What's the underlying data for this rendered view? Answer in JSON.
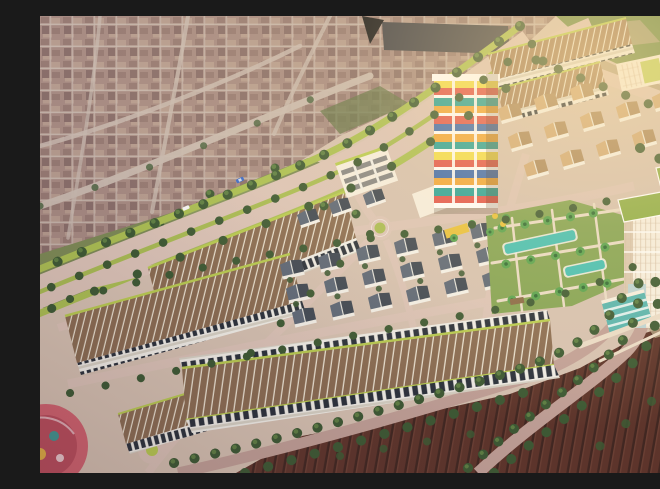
{
  "meta": {
    "title": "Aerial 3D architectural rendering of a residential master-plan development beside an existing town",
    "style": "photorealistic bird's-eye render",
    "lighting": "warm golden-hour glow from upper right",
    "width_px": 660,
    "height_px": 457
  },
  "palette": {
    "ground": "#d6c2b2",
    "town_base": "#a78b83",
    "town_b1": "#977b74",
    "town_b2": "#b69c8f",
    "town_b3": "#8a6f6b",
    "town_street": "#c9bab0",
    "factory": "#45464c",
    "field": "#7d8b56",
    "field_dark": "#66754b",
    "field_light": "#8d9c63",
    "field_top": "#6f8c49",
    "slope": "#b4a285",
    "road": "#dcc4b8",
    "road_dark": "#c2a198",
    "median": "#a9bc54",
    "verge": "#abc053",
    "tree": "#3d5a34",
    "tree_light": "#5e8044",
    "palm": "#57a350",
    "palm_dark": "#2f6b35",
    "roof_brown": "#8b6d53",
    "roof_warm": "#a37f5c",
    "roof_sep": "#ece4d3",
    "facade_white": "#f1efe8",
    "facade_dark": "#2b323c",
    "ledge": "#d8d3c6",
    "accent_green": "#b9cc52",
    "villa_roof": "#3f4854",
    "villa_roof_light": "#5d6878",
    "villa_wall": "#f4f1ea",
    "villa_tan": "#a9875f",
    "villa_tan_light": "#cfa878",
    "pool": "#45c0b5",
    "lawn": "#84a455",
    "path": "#eadcc8",
    "tower_white": "#f6efe2",
    "tower_shadow": "#d4bfa8",
    "green_roof": "#8fae4a",
    "glass": "#bdd4d6",
    "glass_teal": "#58b5b0",
    "oldtown": "#6b3b31",
    "oldtown_dark": "#472a25",
    "oldtown_ridge": "#7c493c",
    "playground": "#d2636f",
    "playground_dark": "#bb4d5c",
    "awning": "#e8c23e",
    "pergola": "#8a6a48",
    "car_blue": "#3a6bc9",
    "car_white": "#f8f8f8",
    "glow": "#ffdf9e",
    "tw1": "#e2574e",
    "tw2": "#f0a73c",
    "tw3": "#29a39b",
    "tw4": "#f2dd4e",
    "tw5": "#3f6cb0",
    "tw6": "#ffffff"
  },
  "regions": [
    "existing-town-northwest",
    "industrial-warehouse",
    "farmland-buffer",
    "hillside-field-northeast",
    "main-boulevard-with-tree-median",
    "internal-road-network",
    "central-roundabout",
    "plaza-circle-southwest",
    "shophouse-row-upper",
    "shophouse-row-left",
    "shophouse-row-bottom",
    "shophouse-rows-northeast",
    "white-apartment-strip",
    "villa-district-central",
    "villa-district-north",
    "villa-district-east-tan",
    "central-park-with-pools-and-palms",
    "mixed-use-colorful-tower",
    "highrise-towers-east",
    "glass-pavilion",
    "clubhouse",
    "old-town-southeast",
    "curved-tree-lined-road",
    "playground-mural-circle",
    "street-trees",
    "vehicles",
    "golden-hour-glow"
  ]
}
